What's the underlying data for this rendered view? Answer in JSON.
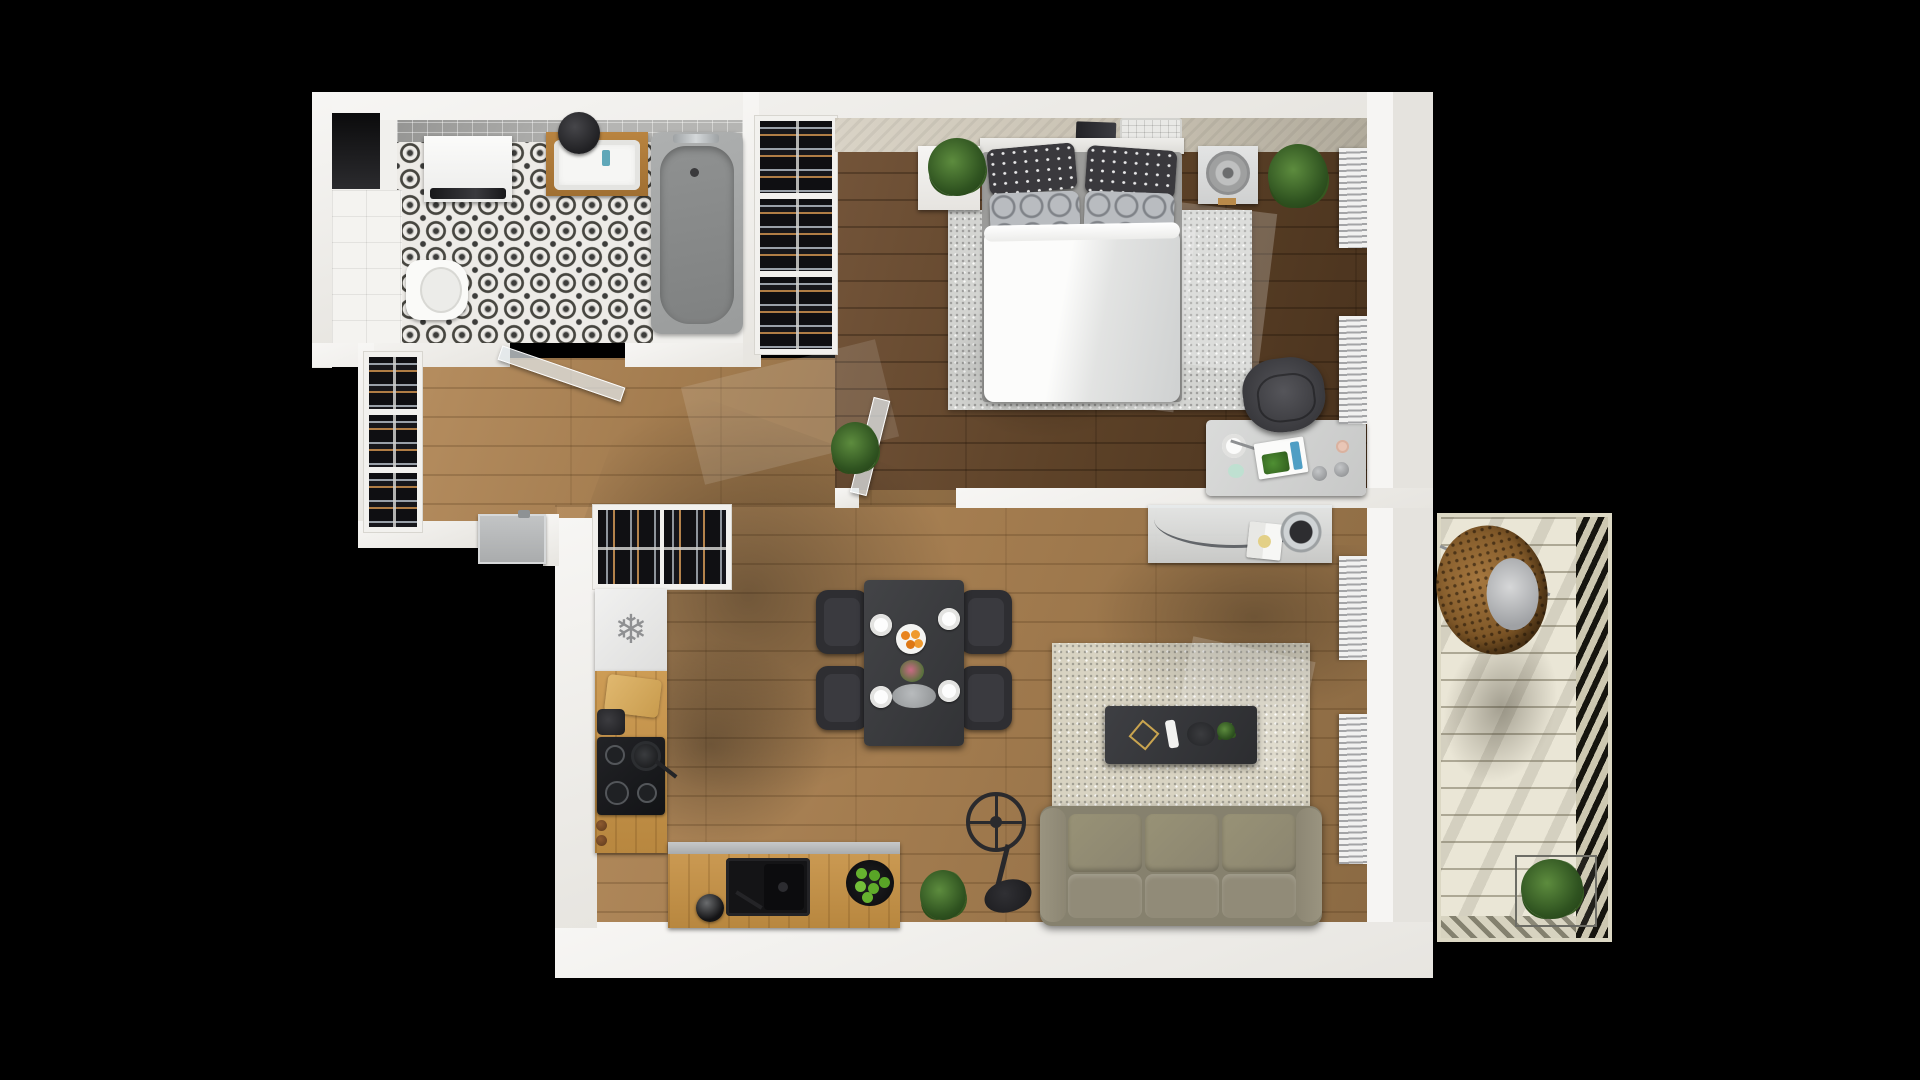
{
  "scene": {
    "type": "apartment-floor-plan-3d-top-view",
    "background": "#000000",
    "render_style": "photoreal top-down render, no visible text"
  },
  "icons": {
    "snowflake": "❄"
  },
  "colors": {
    "wall": "#f7f6f4",
    "wall-shade": "#e7e5e0",
    "wood-light": "#a37c4f",
    "wood-dark": "#5d4228",
    "tile-ink": "#3d3d3b",
    "tile-bg": "#edebe7",
    "rug-gray": "#d3d4d1",
    "rug-beige": "#d8d3c2",
    "sofa-fabric": "#8e8876",
    "table-dark": "#3b3c3f",
    "chair-dark": "#2f2f33",
    "counter-wood": "#c2914d",
    "appliance-white": "#ececec",
    "metal-gray": "#b7b9ba",
    "plant-green": "#3f6b2c",
    "apple-green": "#63b02e",
    "fruit-orange": "#e8841e",
    "rattan-brown": "#9c6b35",
    "deck-cream": "#eae6d6",
    "bathtub-gray": "#a7a9a9",
    "stove-black": "#1b1c1e"
  },
  "rooms": {
    "bathroom": {
      "floor": "black-white-quatrefoil-tile",
      "fixtures": [
        "entry-niche",
        "washing-machine",
        "white-tile-counter",
        "toilet",
        "wall-sink-wood-shelf",
        "round-mirror",
        "bathtub",
        "glass-door"
      ]
    },
    "hallway": {
      "floor": "light-oak-planks",
      "fixtures": [
        "shoe-cabinet",
        "utility-unit"
      ]
    },
    "bedroom": {
      "floor": "dark-walnut-planks",
      "fixtures": [
        "open-wardrobe-hangers",
        "headboard-shelf",
        "laptop",
        "tray",
        "double-bed",
        "polka-dot-pillows",
        "circle-pattern-pillows",
        "gray-rug",
        "nightstand",
        "potted-plant-left",
        "fan-unit",
        "potted-plant-right",
        "desk",
        "desk-accessories",
        "office-chair",
        "window-radiators",
        "glass-door"
      ]
    },
    "kitchen": {
      "floor": "light-oak-planks",
      "fixtures": [
        "cutlery-sideboard",
        "fridge-freezer",
        "wood-counter",
        "cutting-board",
        "coffee-maker",
        "induction-hob",
        "pan",
        "lower-counter",
        "black-sink",
        "kettle",
        "apple-bowl",
        "potted-plant"
      ]
    },
    "dining": {
      "fixtures": [
        "black-dining-table",
        "four-chairs",
        "four-place-settings",
        "orange-fruit-plate",
        "flower-vase",
        "serving-tray",
        "floor-plant"
      ]
    },
    "living": {
      "floor": "light-oak-planks",
      "fixtures": [
        "glass-tv-console",
        "round-mirror",
        "open-book",
        "beige-rug",
        "coffee-table",
        "gold-decor",
        "remote",
        "round-tray",
        "small-plant",
        "three-seat-sofa",
        "stand-fan",
        "window-radiators"
      ]
    },
    "balcony": {
      "floor": "cream-decking",
      "fixtures": [
        "hanging-egg-chair",
        "chair-cushion",
        "wire-planter-plant",
        "louvered-railing"
      ]
    }
  }
}
